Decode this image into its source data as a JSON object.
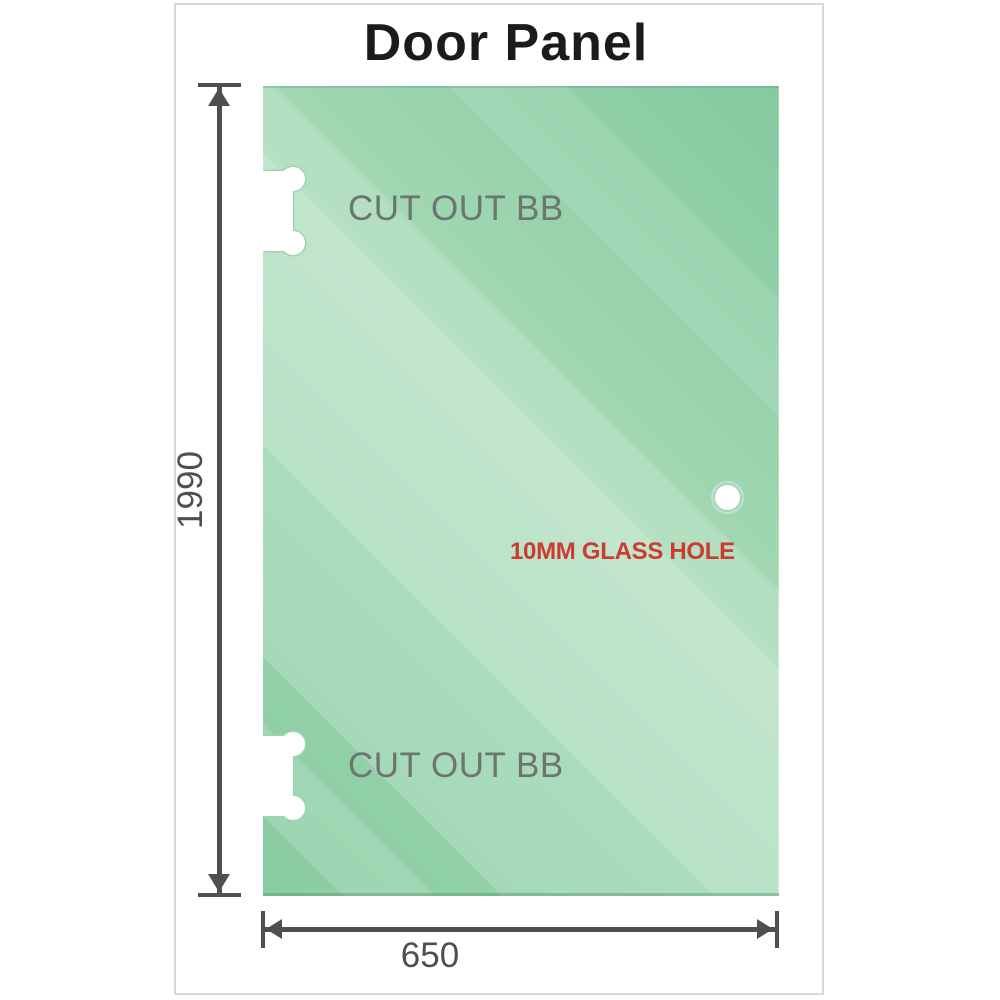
{
  "title": "Door Panel",
  "panel": {
    "cutouts": [
      {
        "label": "CUT OUT BB"
      },
      {
        "label": "CUT OUT BB"
      }
    ],
    "hole": {
      "label": "10MM GLASS HOLE"
    }
  },
  "dimensions": {
    "height": "1990",
    "width": "650"
  },
  "colors": {
    "title": "#1b1b1b",
    "frame_border": "#d8d8d8",
    "glass_dark": "#8acca2",
    "glass_light": "#c3e6d0",
    "cutout_label": "#6b7672",
    "hole_label": "#ce3a2f",
    "dim_line": "#4f4f4f"
  }
}
